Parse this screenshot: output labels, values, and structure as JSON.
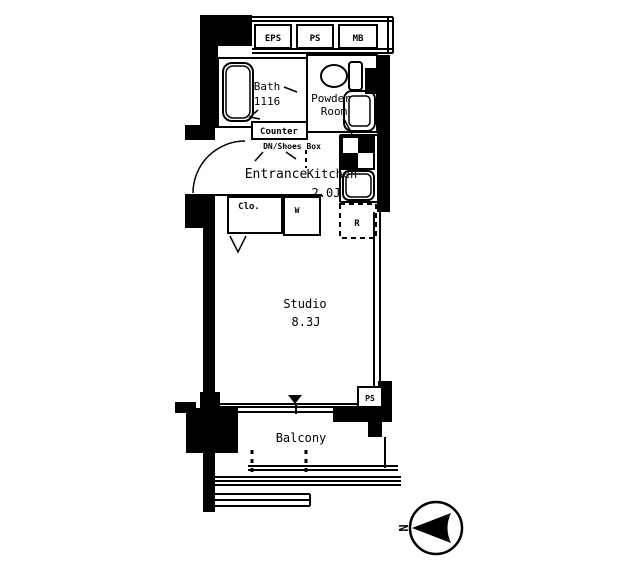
{
  "plan": {
    "service_boxes": {
      "eps": "EPS",
      "ps": "PS",
      "mb": "MB"
    },
    "rooms": {
      "bath": {
        "name": "Bath",
        "size": "1116"
      },
      "powder_room": {
        "line1": "Powder",
        "line2": "Room"
      },
      "entrance": {
        "name": "Entrance"
      },
      "kitchen": {
        "name": "Kitchen",
        "size": "2.0J"
      },
      "studio": {
        "name": "Studio",
        "size": "8.3J"
      },
      "balcony": {
        "name": "Balcony"
      }
    },
    "labels": {
      "counter": "Counter",
      "shoes_box": "DN/Shoes Box",
      "closet": "Clo.",
      "washer": "W",
      "refrigerator": "R",
      "pipe_space": "PS"
    },
    "compass": {
      "north": "N"
    },
    "colors": {
      "ink": "#000000",
      "paper": "#ffffff"
    }
  }
}
